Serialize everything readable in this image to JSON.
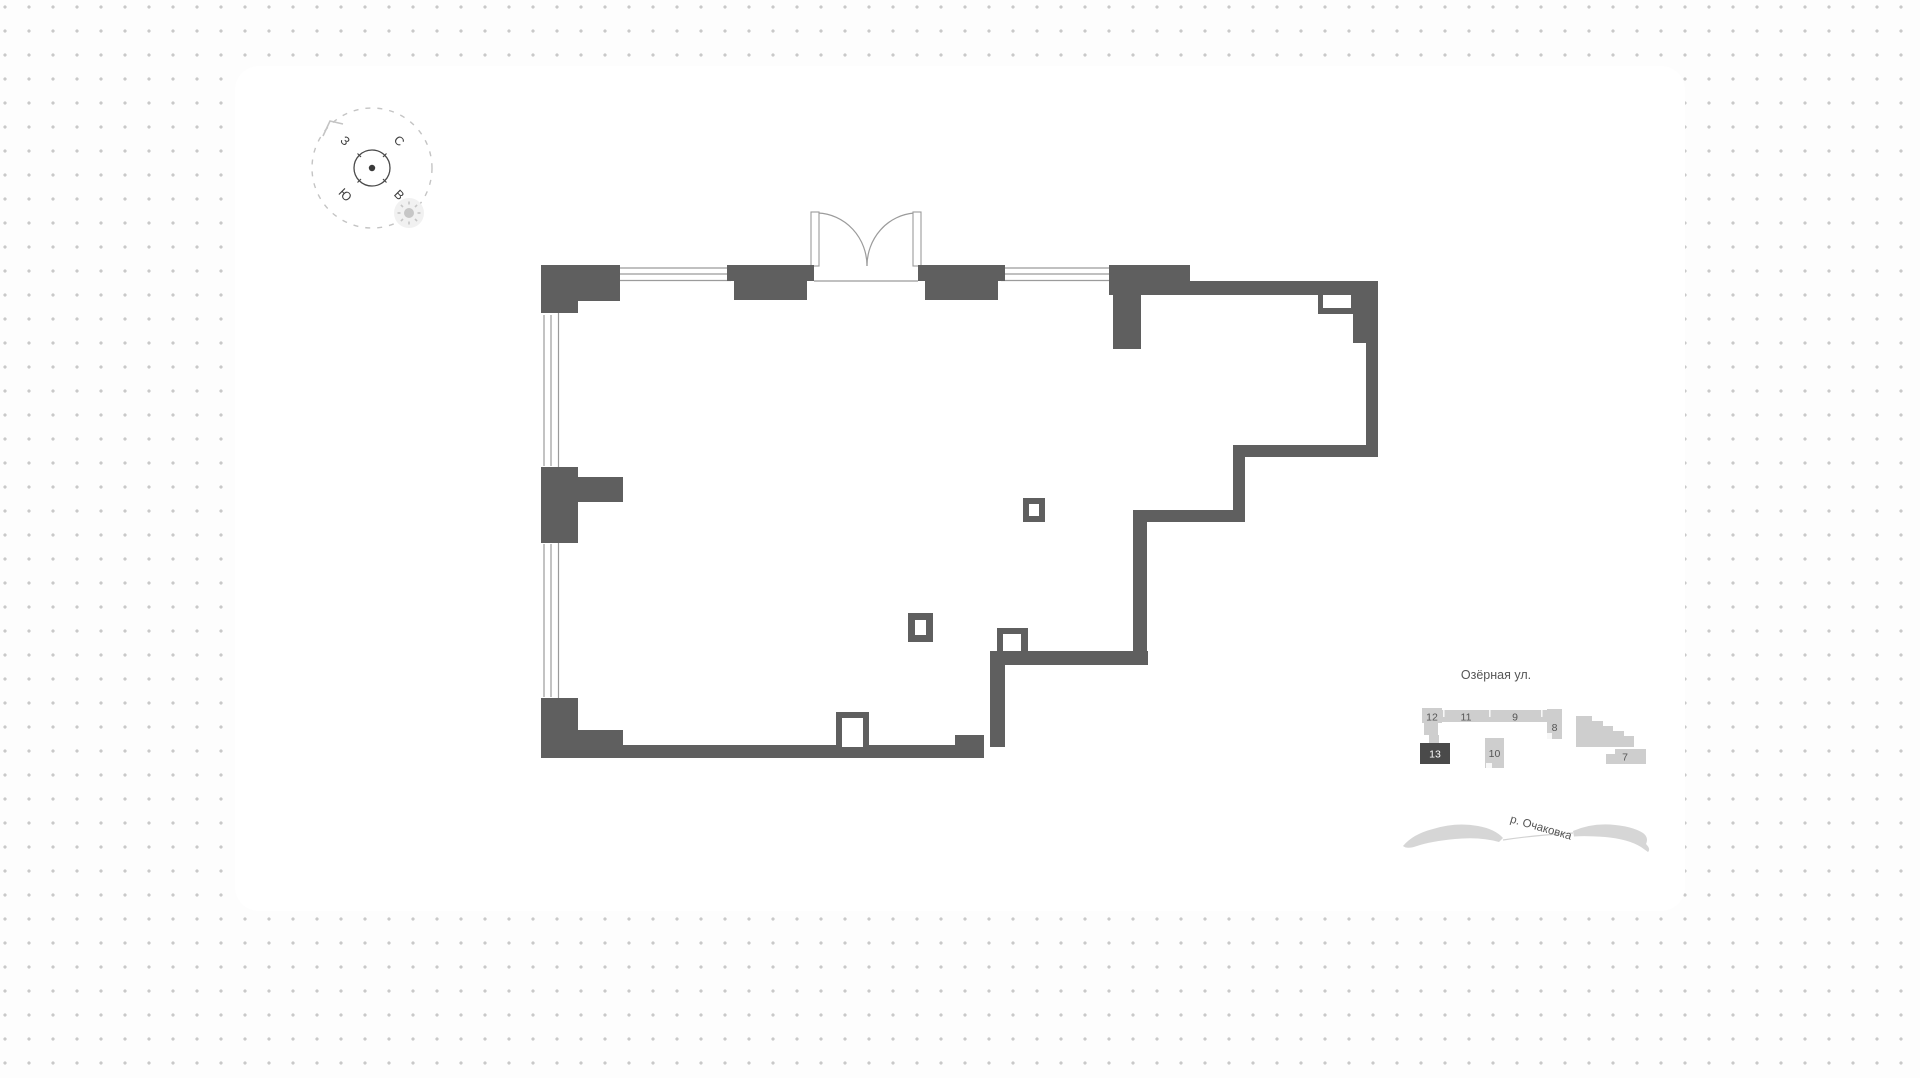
{
  "compass": {
    "north": "С",
    "south": "Ю",
    "west": "З",
    "east": "В"
  },
  "minimap": {
    "street_label": "Озёрная ул.",
    "river_label": "р. Очаковка",
    "buildings": {
      "b12": {
        "label": "12",
        "highlighted": false
      },
      "b11": {
        "label": "11",
        "highlighted": false
      },
      "b9": {
        "label": "9",
        "highlighted": false
      },
      "b8": {
        "label": "8",
        "highlighted": false
      },
      "b10": {
        "label": "10",
        "highlighted": false
      },
      "b7": {
        "label": "7",
        "highlighted": false
      },
      "b13": {
        "label": "13",
        "highlighted": true
      }
    }
  },
  "colors": {
    "wall": "#5f5f5f",
    "thin_line": "#9b9b9b",
    "building": "#cecece",
    "building_highlight": "#4a4a4a",
    "text": "#555555",
    "compass_text": "#3f3f3f",
    "dashed_circle": "#c4c4c4",
    "sun": "#c6c6c6"
  }
}
